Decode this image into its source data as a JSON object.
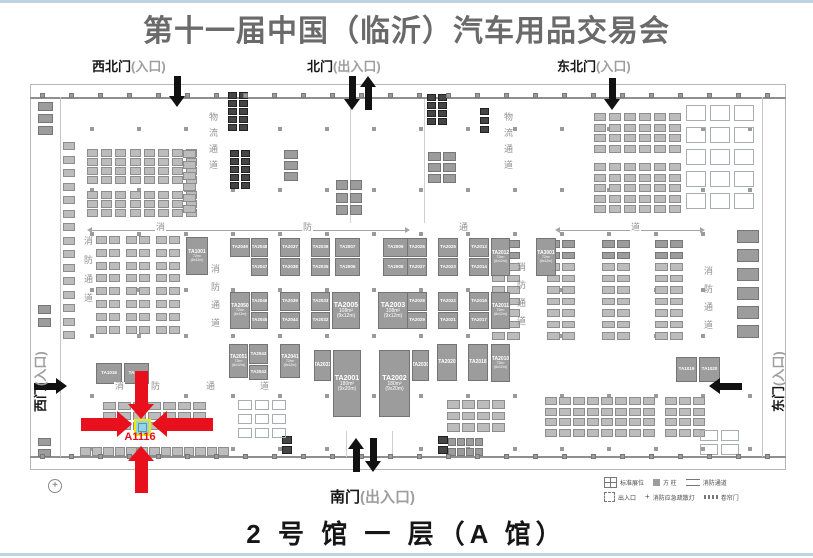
{
  "page": {
    "title": "第十一届中国（临沂）汽车用品交易会",
    "footer": "2 号 馆 一 层（A 馆）"
  },
  "gates": [
    {
      "name": "northwest-gate",
      "label": "西北门",
      "suffix": "(入口)"
    },
    {
      "name": "north-gate",
      "label": "北门",
      "suffix": "(出入口)"
    },
    {
      "name": "northeast-gate",
      "label": "东北门",
      "suffix": "(入口)"
    },
    {
      "name": "south-gate",
      "label": "南门",
      "suffix": "(出入口)"
    },
    {
      "name": "west-gate",
      "label": "西门",
      "suffix": "(入口)"
    },
    {
      "name": "east-gate",
      "label": "东门",
      "suffix": "(入口)"
    }
  ],
  "highlight": {
    "booth": "A1116",
    "accent_color": "#e8101c",
    "box_border": "#f4e800",
    "box_fill": "#8fd6e8"
  },
  "lanes": {
    "vertical": [
      {
        "text": "物流通道",
        "x": 207,
        "y": 112,
        "h": 68,
        "ls": 7
      },
      {
        "text": "物流通道",
        "x": 502,
        "y": 112,
        "h": 68,
        "ls": 7
      },
      {
        "text": "消防通道",
        "x": 82,
        "y": 236,
        "h": 82,
        "ls": 10
      },
      {
        "text": "消防通道",
        "x": 209,
        "y": 264,
        "h": 76,
        "ls": 9
      },
      {
        "text": "消防通道",
        "x": 515,
        "y": 262,
        "h": 76,
        "ls": 9
      },
      {
        "text": "消防通道",
        "x": 702,
        "y": 266,
        "h": 74,
        "ls": 9
      }
    ],
    "chars": [
      {
        "text": "消",
        "x": 155,
        "y": 223
      },
      {
        "text": "防",
        "x": 302,
        "y": 223
      },
      {
        "text": "通",
        "x": 458,
        "y": 223
      },
      {
        "text": "道",
        "x": 630,
        "y": 223
      },
      {
        "text": "消",
        "x": 114,
        "y": 382
      },
      {
        "text": "防",
        "x": 150,
        "y": 382
      },
      {
        "text": "通",
        "x": 205,
        "y": 382
      },
      {
        "text": "道",
        "x": 259,
        "y": 382
      }
    ],
    "lines": [
      {
        "x1": 92,
        "x2": 405,
        "y": 230
      },
      {
        "x1": 560,
        "x2": 700,
        "y": 230
      }
    ]
  },
  "booths": {
    "large": [
      {
        "label": "TA1001",
        "x": 186,
        "y": 237,
        "w": 22,
        "h": 38,
        "sub": [
          "72m²",
          "(6x12m)"
        ]
      },
      {
        "label": "TA2049",
        "x": 230,
        "y": 238,
        "w": 20,
        "h": 19
      },
      {
        "label": "TA2048",
        "x": 251,
        "y": 238,
        "w": 17,
        "h": 19
      },
      {
        "label": "TA2047",
        "x": 251,
        "y": 258,
        "w": 17,
        "h": 18
      },
      {
        "label": "TA2037",
        "x": 280,
        "y": 238,
        "w": 20,
        "h": 19
      },
      {
        "label": "TA2038",
        "x": 280,
        "y": 258,
        "w": 20,
        "h": 18
      },
      {
        "label": "TA2036",
        "x": 311,
        "y": 238,
        "w": 19,
        "h": 19
      },
      {
        "label": "TA2035",
        "x": 311,
        "y": 258,
        "w": 19,
        "h": 18
      },
      {
        "label": "TA2007",
        "x": 335,
        "y": 238,
        "w": 25,
        "h": 19
      },
      {
        "label": "TA2006",
        "x": 335,
        "y": 258,
        "w": 25,
        "h": 18
      },
      {
        "label": "TA2009",
        "x": 383,
        "y": 238,
        "w": 25,
        "h": 19
      },
      {
        "label": "TA2008",
        "x": 383,
        "y": 258,
        "w": 25,
        "h": 18
      },
      {
        "label": "TA2026",
        "x": 407,
        "y": 238,
        "w": 20,
        "h": 19
      },
      {
        "label": "TA2027",
        "x": 407,
        "y": 258,
        "w": 20,
        "h": 18
      },
      {
        "label": "TA2025",
        "x": 438,
        "y": 238,
        "w": 20,
        "h": 19
      },
      {
        "label": "TA2023",
        "x": 438,
        "y": 258,
        "w": 20,
        "h": 18
      },
      {
        "label": "TA2013",
        "x": 469,
        "y": 238,
        "w": 20,
        "h": 19
      },
      {
        "label": "TA2014",
        "x": 469,
        "y": 258,
        "w": 20,
        "h": 18
      },
      {
        "label": "TA2012",
        "x": 491,
        "y": 238,
        "w": 19,
        "h": 38,
        "sub": [
          "72m²",
          "(6x12m)"
        ]
      },
      {
        "label": "TA3001",
        "x": 536,
        "y": 238,
        "w": 20,
        "h": 38,
        "sub": [
          "72m²",
          "(6x12m)"
        ]
      },
      {
        "label": "TA2050",
        "x": 230,
        "y": 292,
        "w": 20,
        "h": 37,
        "sub": [
          "72m²",
          "(6x12m)"
        ]
      },
      {
        "label": "TA2046",
        "x": 251,
        "y": 292,
        "w": 17,
        "h": 19
      },
      {
        "label": "TA2045",
        "x": 251,
        "y": 312,
        "w": 17,
        "h": 17
      },
      {
        "label": "TA2039",
        "x": 280,
        "y": 292,
        "w": 20,
        "h": 19
      },
      {
        "label": "TA2044",
        "x": 280,
        "y": 312,
        "w": 20,
        "h": 17
      },
      {
        "label": "TA2033",
        "x": 311,
        "y": 292,
        "w": 19,
        "h": 19
      },
      {
        "label": "TA2032",
        "x": 311,
        "y": 312,
        "w": 19,
        "h": 17
      },
      {
        "label": "TA2005",
        "x": 332,
        "y": 292,
        "w": 28,
        "h": 37,
        "sub": [
          "108m²",
          "(9x12m)"
        ],
        "big": true
      },
      {
        "label": "TA2003",
        "x": 378,
        "y": 292,
        "w": 30,
        "h": 37,
        "sub": [
          "108m²",
          "(9x12m)"
        ],
        "big": true
      },
      {
        "label": "TA2028",
        "x": 407,
        "y": 292,
        "w": 20,
        "h": 19
      },
      {
        "label": "TA2029",
        "x": 407,
        "y": 312,
        "w": 20,
        "h": 17
      },
      {
        "label": "TA2022",
        "x": 438,
        "y": 292,
        "w": 20,
        "h": 19
      },
      {
        "label": "TA2021",
        "x": 438,
        "y": 312,
        "w": 20,
        "h": 17
      },
      {
        "label": "TA2016",
        "x": 469,
        "y": 292,
        "w": 20,
        "h": 19
      },
      {
        "label": "TA2017",
        "x": 469,
        "y": 312,
        "w": 20,
        "h": 17
      },
      {
        "label": "TA2011",
        "x": 491,
        "y": 292,
        "w": 19,
        "h": 37,
        "sub": [
          "72m²",
          "(6x12m)"
        ]
      },
      {
        "label": "TA2051",
        "x": 229,
        "y": 344,
        "w": 19,
        "h": 34,
        "sub": [
          "72m²",
          "(6x12m)"
        ]
      },
      {
        "label": "TA2043",
        "x": 249,
        "y": 344,
        "w": 19,
        "h": 20
      },
      {
        "label": "TA2042",
        "x": 249,
        "y": 365,
        "w": 19,
        "h": 15
      },
      {
        "label": "TA2041",
        "x": 280,
        "y": 344,
        "w": 20,
        "h": 34,
        "sub": [
          "72m²",
          "(6x12m)"
        ]
      },
      {
        "label": "TA2031",
        "x": 314,
        "y": 350,
        "w": 17,
        "h": 31
      },
      {
        "label": "TA2001",
        "x": 333,
        "y": 350,
        "w": 28,
        "h": 67,
        "sub": [
          "180m²",
          "(9x20m)"
        ],
        "big": true
      },
      {
        "label": "TA2002",
        "x": 379,
        "y": 350,
        "w": 31,
        "h": 67,
        "sub": [
          "180m²",
          "(9x20m)"
        ],
        "big": true
      },
      {
        "label": "TA2030",
        "x": 412,
        "y": 350,
        "w": 17,
        "h": 31
      },
      {
        "label": "TA2020",
        "x": 437,
        "y": 344,
        "w": 20,
        "h": 37
      },
      {
        "label": "TA2018",
        "x": 468,
        "y": 344,
        "w": 20,
        "h": 37
      },
      {
        "label": "TA2010",
        "x": 491,
        "y": 344,
        "w": 19,
        "h": 38,
        "sub": [
          "72m²",
          "(6x12m)"
        ]
      },
      {
        "label": "TA1016",
        "x": 96,
        "y": 363,
        "w": 26,
        "h": 21
      },
      {
        "label": "TA1017",
        "x": 124,
        "y": 363,
        "w": 25,
        "h": 21
      },
      {
        "label": "TA1019",
        "x": 676,
        "y": 357,
        "w": 21,
        "h": 25
      },
      {
        "label": "TA1020",
        "x": 699,
        "y": 357,
        "w": 21,
        "h": 25
      }
    ]
  },
  "plan": {
    "small_blocks": [
      {
        "x": 87,
        "y": 149,
        "cols": 8,
        "rows": 4,
        "cw": 11,
        "ch": 7.5,
        "gx": 3.2,
        "gy": 1.5,
        "shade": "light"
      },
      {
        "x": 87,
        "y": 191,
        "cols": 8,
        "rows": 3,
        "cw": 11,
        "ch": 7.5,
        "gx": 3.2,
        "gy": 1.5,
        "shade": "light"
      },
      {
        "x": 183,
        "y": 150,
        "cols": 1,
        "rows": 6,
        "cw": 13,
        "ch": 8,
        "gx": 0,
        "gy": 3,
        "shade": "light"
      },
      {
        "x": 63,
        "y": 142,
        "cols": 1,
        "rows": 15,
        "cw": 12,
        "ch": 8,
        "gx": 0,
        "gy": 5.5,
        "shade": "light"
      },
      {
        "x": 38,
        "y": 102,
        "cols": 1,
        "rows": 3,
        "cw": 15,
        "ch": 9,
        "gx": 0,
        "gy": 3,
        "shade": "mid"
      },
      {
        "x": 38,
        "y": 305,
        "cols": 1,
        "rows": 2,
        "cw": 13,
        "ch": 9,
        "gx": 0,
        "gy": 4,
        "shade": "mid"
      },
      {
        "x": 38,
        "y": 438,
        "cols": 1,
        "rows": 2,
        "cw": 13,
        "ch": 8,
        "gx": 0,
        "gy": 3,
        "shade": "mid"
      },
      {
        "x": 96,
        "y": 236,
        "cols": 2,
        "rows": 8,
        "cw": 11,
        "ch": 8,
        "gx": 2,
        "gy": 4.8,
        "shade": "light"
      },
      {
        "x": 126,
        "y": 236,
        "cols": 2,
        "rows": 8,
        "cw": 11,
        "ch": 8,
        "gx": 2,
        "gy": 4.8,
        "shade": "light"
      },
      {
        "x": 156,
        "y": 236,
        "cols": 2,
        "rows": 8,
        "cw": 11,
        "ch": 8,
        "gx": 2,
        "gy": 4.8,
        "shade": "light"
      },
      {
        "x": 594,
        "y": 113,
        "cols": 6,
        "rows": 4,
        "cw": 12,
        "ch": 8,
        "gx": 3,
        "gy": 2.5,
        "shade": "light"
      },
      {
        "x": 594,
        "y": 163,
        "cols": 6,
        "rows": 5,
        "cw": 12,
        "ch": 8,
        "gx": 3,
        "gy": 2.5,
        "shade": "light"
      },
      {
        "x": 686,
        "y": 105,
        "cols": 3,
        "rows": 5,
        "cw": 20,
        "ch": 16,
        "gx": 4,
        "gy": 6,
        "shade": "outline"
      },
      {
        "x": 492,
        "y": 240,
        "cols": 2,
        "rows": 9,
        "cw": 13,
        "ch": 7.5,
        "gx": 1.5,
        "gy": 4,
        "shade": "light"
      },
      {
        "x": 547,
        "y": 240,
        "cols": 2,
        "rows": 9,
        "cw": 13,
        "ch": 7.5,
        "gx": 1.5,
        "gy": 4,
        "shade": "light"
      },
      {
        "x": 602,
        "y": 240,
        "cols": 2,
        "rows": 9,
        "cw": 13,
        "ch": 7.5,
        "gx": 1.5,
        "gy": 4,
        "shade": "light"
      },
      {
        "x": 655,
        "y": 240,
        "cols": 2,
        "rows": 9,
        "cw": 13,
        "ch": 7.5,
        "gx": 1.5,
        "gy": 4,
        "shade": "light"
      },
      {
        "x": 492,
        "y": 240,
        "cols": 2,
        "rows": 2,
        "cw": 13,
        "ch": 7.5,
        "gx": 1.5,
        "gy": 4,
        "shade": "mid"
      },
      {
        "x": 547,
        "y": 240,
        "cols": 2,
        "rows": 2,
        "cw": 13,
        "ch": 7.5,
        "gx": 1.5,
        "gy": 4,
        "shade": "mid"
      },
      {
        "x": 602,
        "y": 240,
        "cols": 2,
        "rows": 2,
        "cw": 13,
        "ch": 7.5,
        "gx": 1.5,
        "gy": 4,
        "shade": "mid"
      },
      {
        "x": 655,
        "y": 240,
        "cols": 2,
        "rows": 2,
        "cw": 13,
        "ch": 7.5,
        "gx": 1.5,
        "gy": 4,
        "shade": "mid"
      },
      {
        "x": 737,
        "y": 230,
        "cols": 1,
        "rows": 6,
        "cw": 22,
        "ch": 13,
        "gx": 0,
        "gy": 6,
        "shade": "mid"
      },
      {
        "x": 103,
        "y": 402,
        "cols": 7,
        "rows": 3,
        "cw": 13,
        "ch": 8,
        "gx": 2,
        "gy": 2,
        "shade": "light"
      },
      {
        "x": 80,
        "y": 447,
        "cols": 13,
        "rows": 1,
        "cw": 10.5,
        "ch": 9,
        "gx": 1,
        "gy": 0,
        "shade": "light"
      },
      {
        "x": 447,
        "y": 400,
        "cols": 4,
        "rows": 3,
        "cw": 13,
        "ch": 8.5,
        "gx": 2,
        "gy": 3,
        "shade": "light"
      },
      {
        "x": 545,
        "y": 397,
        "cols": 8,
        "rows": 4,
        "cw": 12,
        "ch": 8,
        "gx": 2,
        "gy": 2.5,
        "shade": "light"
      },
      {
        "x": 665,
        "y": 397,
        "cols": 3,
        "rows": 4,
        "cw": 12,
        "ch": 8,
        "gx": 2,
        "gy": 2.5,
        "shade": "light"
      },
      {
        "x": 228,
        "y": 92,
        "cols": 2,
        "rows": 5,
        "cw": 9,
        "ch": 6.5,
        "gx": 2,
        "gy": 1.5,
        "shade": "dark"
      },
      {
        "x": 230,
        "y": 150,
        "cols": 2,
        "rows": 5,
        "cw": 9,
        "ch": 6.5,
        "gx": 2,
        "gy": 1.5,
        "shade": "dark"
      },
      {
        "x": 427,
        "y": 94,
        "cols": 2,
        "rows": 4,
        "cw": 9,
        "ch": 6.5,
        "gx": 2,
        "gy": 1.5,
        "shade": "dark"
      },
      {
        "x": 480,
        "y": 108,
        "cols": 1,
        "rows": 3,
        "cw": 9,
        "ch": 7,
        "gx": 0,
        "gy": 2,
        "shade": "dark"
      },
      {
        "x": 336,
        "y": 180,
        "cols": 2,
        "rows": 3,
        "cw": 12,
        "ch": 10,
        "gx": 1.5,
        "gy": 2.5,
        "shade": "mid"
      },
      {
        "x": 428,
        "y": 152,
        "cols": 2,
        "rows": 3,
        "cw": 13,
        "ch": 9,
        "gx": 2,
        "gy": 2,
        "shade": "mid"
      },
      {
        "x": 284,
        "y": 150,
        "cols": 1,
        "rows": 3,
        "cw": 14,
        "ch": 9,
        "gx": 0,
        "gy": 2,
        "shade": "mid"
      },
      {
        "x": 282,
        "y": 436,
        "cols": 1,
        "rows": 2,
        "cw": 10,
        "ch": 8,
        "gx": 0,
        "gy": 2,
        "shade": "dark"
      },
      {
        "x": 438,
        "y": 436,
        "cols": 1,
        "rows": 2,
        "cw": 10,
        "ch": 8,
        "gx": 0,
        "gy": 2,
        "shade": "dark"
      },
      {
        "x": 448,
        "y": 438,
        "cols": 4,
        "rows": 2,
        "cw": 8,
        "ch": 8,
        "gx": 1,
        "gy": 2,
        "shade": "mid"
      },
      {
        "x": 238,
        "y": 400,
        "cols": 3,
        "rows": 3,
        "cw": 14,
        "ch": 10,
        "gx": 3,
        "gy": 4,
        "shade": "outline"
      },
      {
        "x": 700,
        "y": 430,
        "cols": 2,
        "rows": 2,
        "cw": 18,
        "ch": 11,
        "gx": 3,
        "gy": 3,
        "shade": "outline"
      },
      {
        "x": 40,
        "y": 93,
        "cols": 26,
        "rows": 1,
        "cw": 5,
        "ch": 5,
        "gx": 24,
        "gy": 0,
        "shade": "mid"
      },
      {
        "x": 40,
        "y": 454,
        "cols": 26,
        "rows": 1,
        "cw": 5,
        "ch": 5,
        "gx": 24,
        "gy": 0,
        "shade": "mid"
      }
    ],
    "columns": {
      "x0": 90,
      "step": 47,
      "count": 15,
      "ys": [
        127,
        188,
        232,
        288,
        334,
        394,
        447
      ],
      "size": 4
    }
  },
  "arrows": {
    "black": [
      {
        "dir": "down",
        "cx": 177,
        "from": 76,
        "to": 107
      },
      {
        "dir": "down",
        "cx": 352,
        "from": 76,
        "to": 110
      },
      {
        "dir": "up",
        "cx": 368,
        "from": 76,
        "to": 110
      },
      {
        "dir": "down",
        "cx": 612,
        "from": 78,
        "to": 110
      },
      {
        "dir": "up",
        "cx": 356,
        "from": 438,
        "to": 472
      },
      {
        "dir": "down",
        "cx": 373,
        "from": 438,
        "to": 472
      },
      {
        "dir": "right",
        "cy": 386,
        "from": 34,
        "to": 67
      },
      {
        "dir": "left",
        "cy": 386,
        "from": 709,
        "to": 742
      }
    ],
    "red": [
      {
        "dir": "down",
        "cx": 141,
        "from": 371,
        "to": 419
      },
      {
        "dir": "up",
        "cx": 141,
        "from": 446,
        "to": 493
      },
      {
        "dir": "right",
        "cy": 424,
        "from": 81,
        "to": 132
      },
      {
        "dir": "left",
        "cy": 424,
        "from": 152,
        "to": 213
      }
    ]
  },
  "legend": {
    "items": [
      {
        "icon": "booth-grid",
        "label": "标准展位"
      },
      {
        "icon": "column-square",
        "label": "方 柱"
      },
      {
        "icon": "fire-lane",
        "label": "消防通道"
      },
      {
        "icon": "entrance",
        "label": "出入口"
      },
      {
        "icon": "emergency-light",
        "label": "消防应急疏散灯"
      },
      {
        "icon": "rolling-door",
        "label": "卷帘门"
      }
    ]
  },
  "compass": {
    "glyph": "+"
  }
}
